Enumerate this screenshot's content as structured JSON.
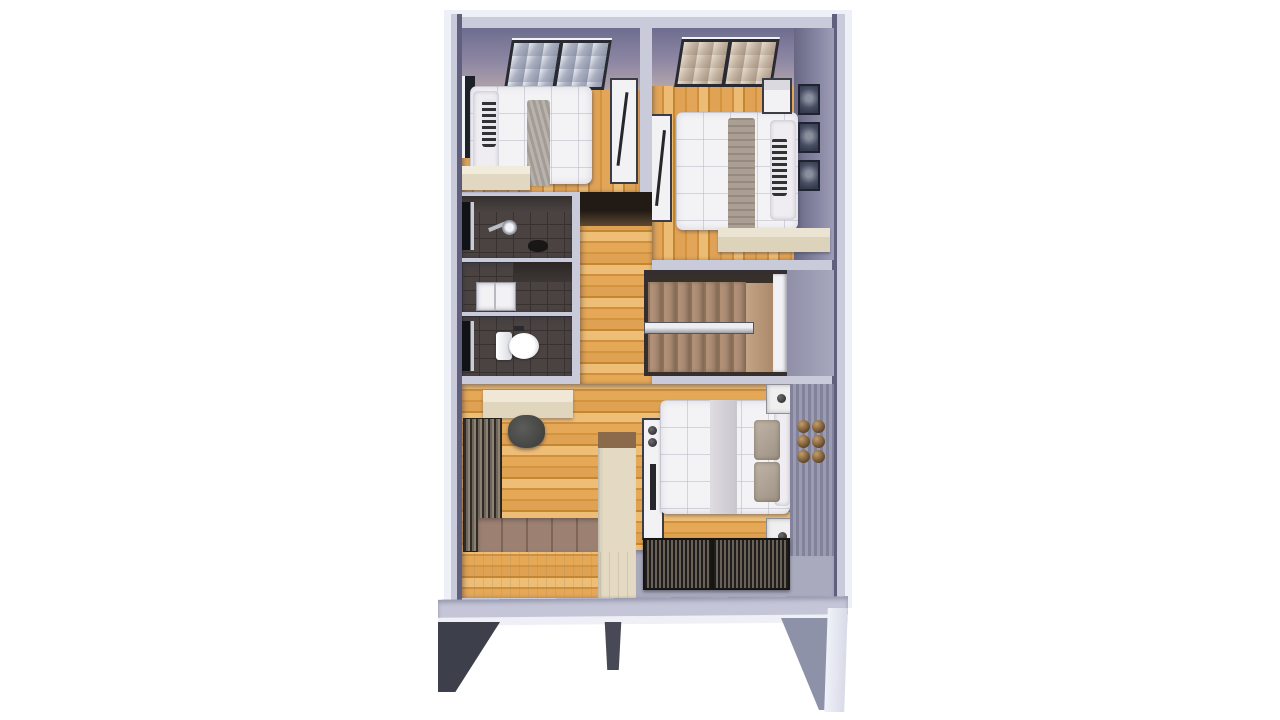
{
  "scene": {
    "description": "3D rendered top-down floor plan of an upper storey, no visible text",
    "rooms": [
      {
        "id": "bedroom-left",
        "features": [
          "skylight",
          "single-bed",
          "side-window",
          "dresser",
          "tv-wardrobe"
        ]
      },
      {
        "id": "bedroom-right",
        "features": [
          "skylight",
          "double-bed",
          "tv-panel",
          "wall-frames",
          "desk"
        ]
      },
      {
        "id": "shower-room",
        "features": [
          "dark-tile-floor",
          "shower-fixture",
          "door"
        ]
      },
      {
        "id": "washbasin-area",
        "features": [
          "dark-tile-floor",
          "white-vanity",
          "counter"
        ]
      },
      {
        "id": "toilet-room",
        "features": [
          "dark-tile-floor",
          "toilet",
          "door"
        ]
      },
      {
        "id": "hallway",
        "features": [
          "wood-floor",
          "dark-threshold"
        ]
      },
      {
        "id": "stairwell",
        "features": [
          "wood-treads",
          "landing",
          "handrail",
          "white-baluster"
        ]
      },
      {
        "id": "master-bedroom",
        "features": [
          "desk",
          "chair",
          "rail-closet",
          "deck-step",
          "cream-cabinets",
          "tv-panel",
          "double-bed",
          "nightstands",
          "bronze-wall-plates",
          "slatted-benches",
          "balcony-floor"
        ]
      }
    ],
    "base": [
      "floor-slab",
      "left-support",
      "center-post",
      "right-support"
    ]
  },
  "counts": {
    "stair_treads": 7,
    "wall_frames": 3,
    "bronze_plates": 6
  },
  "palette": {
    "bg": "#ffffff",
    "wallTop": "#c9cada",
    "wallEdge": "#eef0f7",
    "wallFace": "#8585a3",
    "wallFaceDark": "#60607e",
    "tileDark": "#4a4341",
    "tileLine": "#37312f",
    "stairTread": "#b29279",
    "stairLine": "#8d7058",
    "stairDark": "#38302a",
    "cream": "#e4dac3",
    "brownCap": "#8a6a4a",
    "deck": "#9c8173",
    "deckLine": "#7d6557",
    "balcony": "#a9aabd",
    "slab": "#c4c6d8",
    "supportDark": "#3d404b",
    "supportGray": "#8d92a8",
    "duvet": "#f3f2f5",
    "woodMid": "#dc9c4e",
    "bronze": "#7a5c3a"
  }
}
